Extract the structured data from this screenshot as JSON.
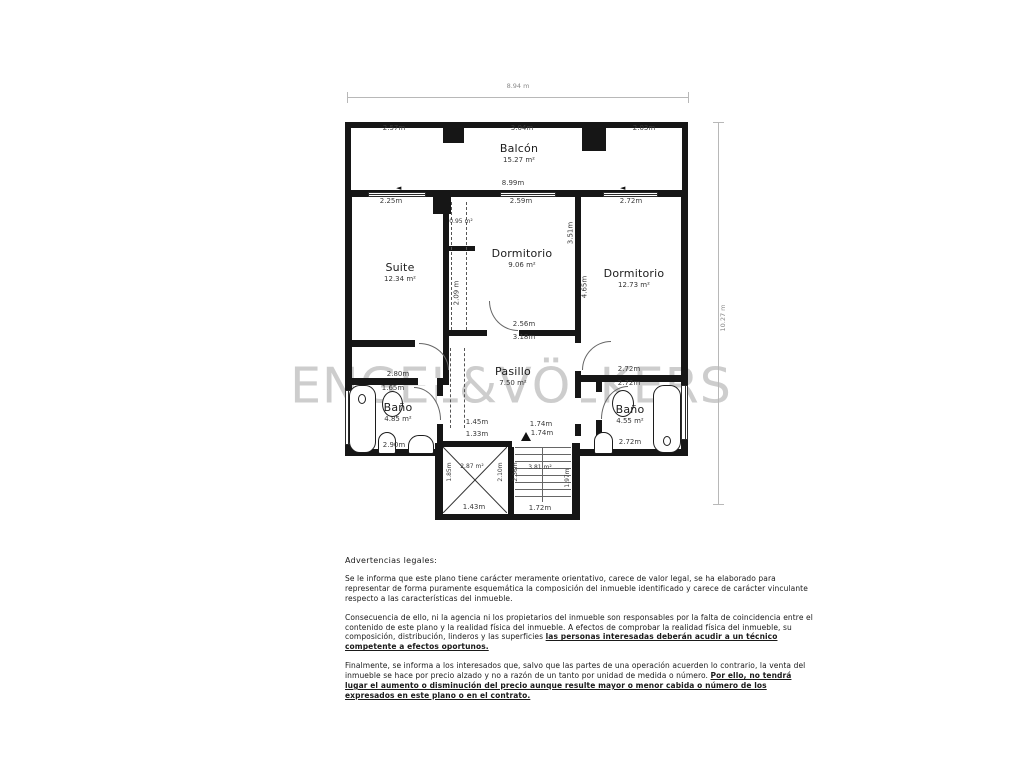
{
  "watermark": "ENGEL&VÖLKERS",
  "plan": {
    "total_width": "8.94 m",
    "total_height": "10.27 m",
    "balcony": {
      "name": "Balcón",
      "area": "15.27 m²"
    },
    "suite": {
      "name": "Suite",
      "area": "12.34 m²"
    },
    "dorm1": {
      "name": "Dormitorio",
      "area": "9.06 m²"
    },
    "dorm2": {
      "name": "Dormitorio",
      "area": "12.73 m²"
    },
    "pasillo": {
      "name": "Pasillo",
      "area": "7.50 m²"
    },
    "bano1": {
      "name": "Baño",
      "area": "4.85 m²"
    },
    "bano2": {
      "name": "Baño",
      "area": "4.55 m²"
    },
    "closet_area": "0.95 m²",
    "lift_area": "2.87 m²",
    "stairs_area": "3.81 m²"
  },
  "dims": {
    "balc_left": "2.57m",
    "balc_center": "3.04m",
    "balc_right": "2.03m",
    "balc_bottom": "8.99m",
    "suite_top": "2.25m",
    "dorm1_top": "2.59m",
    "dorm2_top": "2.72m",
    "dorm1_height": "3.51m",
    "dorm2_height": "4.65m",
    "wardrobe_height": "2.09 m",
    "pasillo_door": "2.56m",
    "pasillo_top": "3.18m",
    "bano1_top": "2.80m",
    "bano1_door": "1.65m",
    "bano1_bottom": "2.90m",
    "bano2_top": "2.72m",
    "bano2_door": "2.72m",
    "bano2_bottom": "2.72m",
    "lift_above": "1.45m",
    "lift_top": "1.33m",
    "lift_bottom": "1.43m",
    "lift_left": "1.85m",
    "lift_right": "2.10m",
    "stairs_top": "1.74m",
    "stairs_top2": "1.74m",
    "stairs_bottom": "1.72m",
    "stairs_left": "2.36m",
    "stairs_right": "1.97m"
  },
  "icons": {
    "door_arrow": "◄"
  },
  "legal": {
    "title": "Advertencias legales:",
    "p1": "Se le informa que este plano tiene carácter meramente orientativo, carece de valor legal, se ha elaborado para representar de forma puramente esquemática la composición del inmueble identificado y carece de carácter vinculante respecto a las características del inmueble.",
    "p2_normal": "Consecuencia de ello, ni la agencia ni los propietarios del inmueble son responsables por la falta de coincidencia entre el contenido de este plano y la realidad física del inmueble. A efectos de comprobar la realidad física del inmueble, su composición, distribución, linderos y las superficies ",
    "p2_emph": "las personas interesadas deberán acudir a un técnico competente a efectos oportunos.",
    "p3_normal": "Finalmente, se informa a los interesados que, salvo que las partes de una operación acuerden lo contrario, la venta del inmueble se hace por precio alzado y no a razón de un tanto por unidad de medida o número. ",
    "p3_emph": "Por ello, no tendrá lugar el aumento o disminución del precio aunque resulte mayor o menor cabida o número de los expresados en este plano o en el contrato."
  }
}
